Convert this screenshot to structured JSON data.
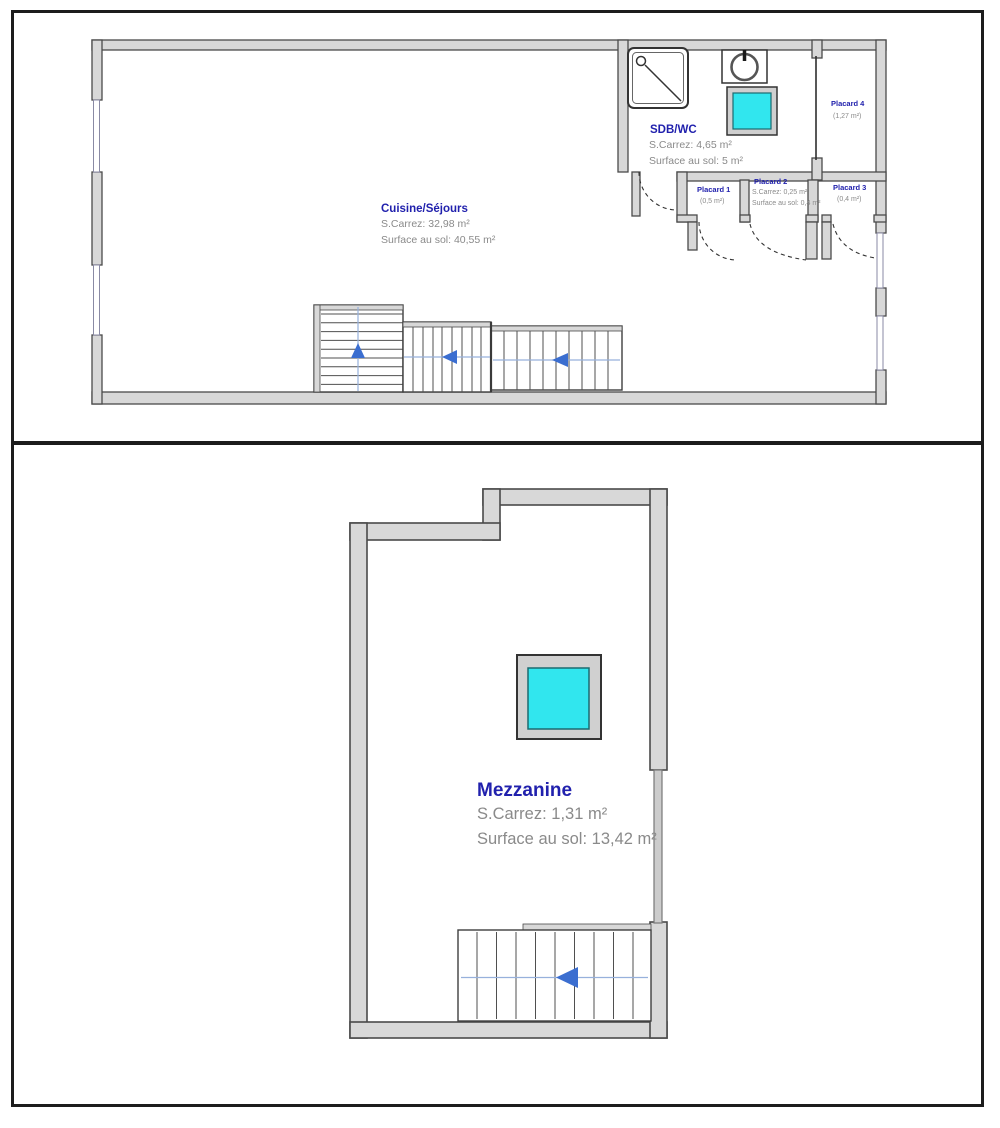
{
  "colors": {
    "room_label": "#2121AD",
    "measure_text": "#8A8A8A",
    "wall_fill": "#D8D8D8",
    "wall_stroke": "#4A4A4A",
    "skylight_cyan": "#31E6EE",
    "stair_arrow_blue": "#3B6ED0",
    "guide_line_blue": "#97B1DC",
    "frame_black": "#1C1C1C"
  },
  "level1": {
    "rooms": {
      "cuisine": {
        "name": "Cuisine/Séjours",
        "carrez": "S.Carrez: 32,98 m²",
        "floor_area": "Surface au sol: 40,55 m²"
      },
      "sdb_wc": {
        "name": "SDB/WC",
        "carrez": "S.Carrez: 4,65 m²",
        "floor_area": "Surface au sol: 5 m²"
      },
      "placard1": {
        "name": "Placard 1",
        "area": "(0,5 m²)"
      },
      "placard2": {
        "name": "Placard 2",
        "carrez": "S.Carrez: 0,25 m²",
        "floor_area": "Surface au sol: 0,4 m²"
      },
      "placard3": {
        "name": "Placard 3",
        "area": "(0,4 m²)"
      },
      "placard4": {
        "name": "Placard 4",
        "area": "(1,27 m²)"
      }
    },
    "icons": [
      "shower-tray-icon",
      "washing-machine-icon",
      "roof-window-icon",
      "stairs-up-arrow-icon",
      "stairs-left-arrow-icon",
      "door-swing-arc"
    ]
  },
  "level2": {
    "rooms": {
      "mezzanine": {
        "name": "Mezzanine",
        "carrez": "S.Carrez: 1,31 m²",
        "floor_area": "Surface au sol: 13,42 m²"
      }
    },
    "icons": [
      "roof-window-icon",
      "stairs-left-arrow-icon",
      "railing"
    ]
  }
}
